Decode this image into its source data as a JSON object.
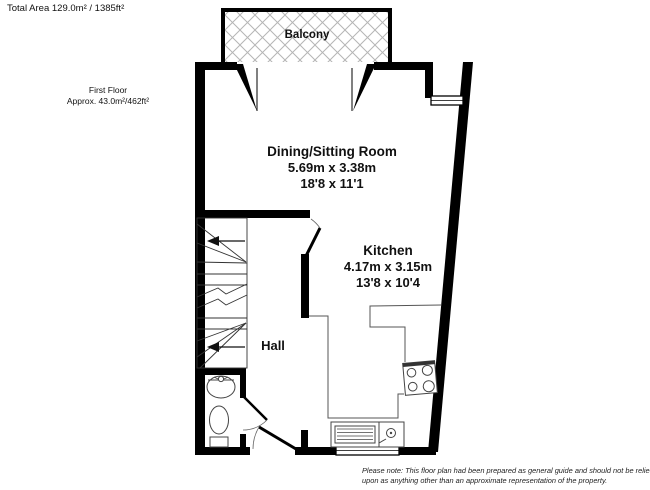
{
  "header": {
    "total_area": "Total Area 129.0m² / 1385ft²"
  },
  "floor": {
    "label": "First Floor",
    "area": "Approx. 43.0m²/462ft²"
  },
  "rooms": {
    "balcony": {
      "name": "Balcony"
    },
    "dining": {
      "name": "Dining/Sitting Room",
      "metric": "5.69m x 3.38m",
      "imperial": "18'8 x 11'1"
    },
    "kitchen": {
      "name": "Kitchen",
      "metric": "4.17m x 3.15m",
      "imperial": "13'8 x 10'4"
    },
    "hall": {
      "name": "Hall"
    }
  },
  "footer": {
    "line1": "Please note: This floor plan had been prepared as general guide and should not be relied",
    "line2": "upon as anything other than an approximate representation of the property."
  },
  "colors": {
    "wall": "#000000",
    "hatch": "#b5b5b5",
    "text": "#111111",
    "background": "#ffffff"
  }
}
